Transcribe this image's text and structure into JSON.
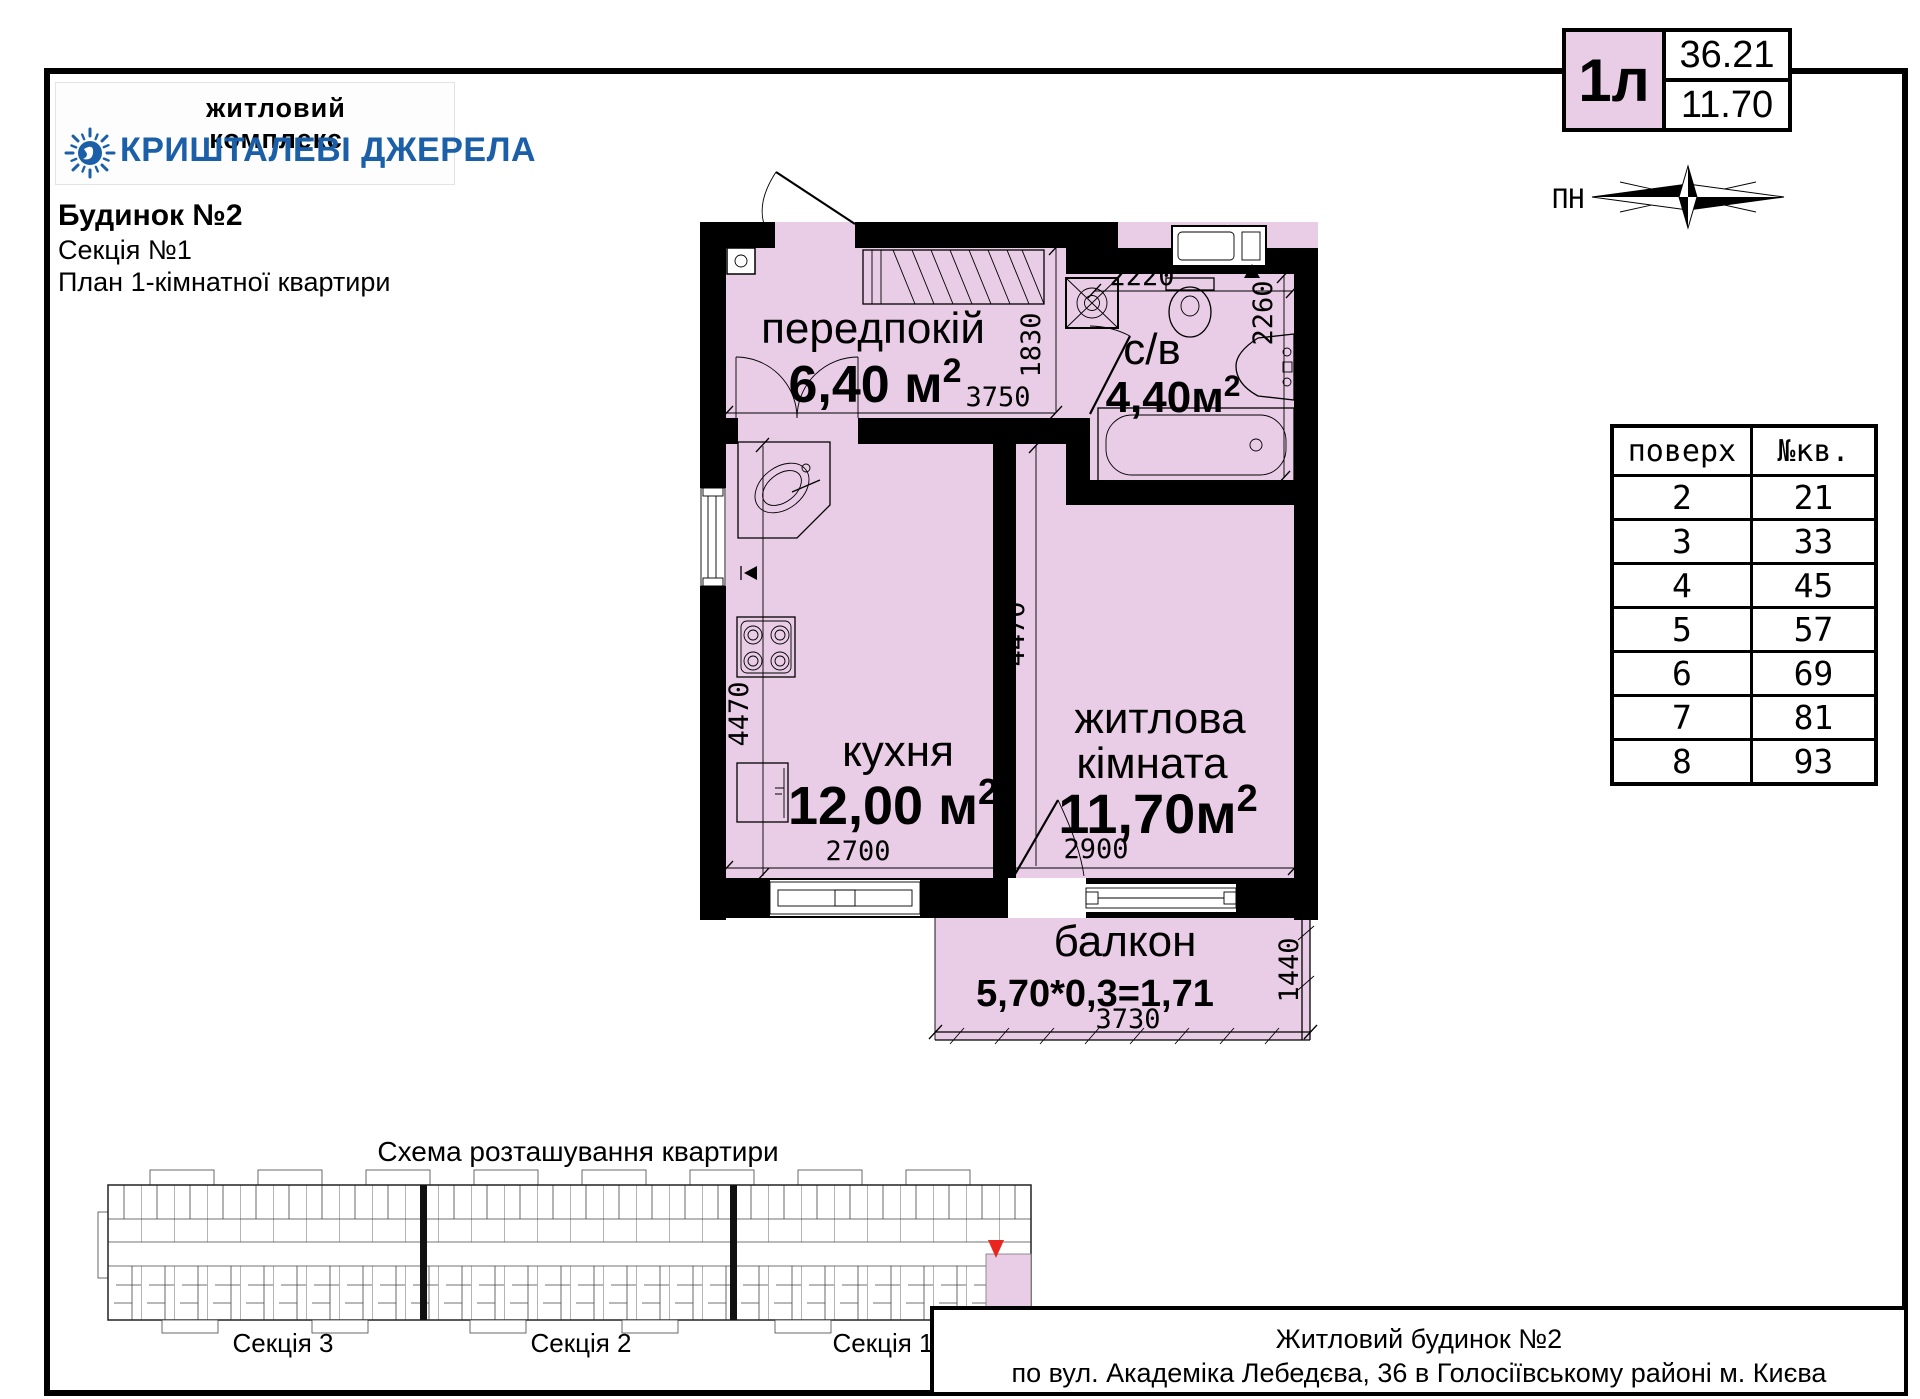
{
  "header": {
    "complex_label": "житловий комплекс",
    "complex_name": "КРИШТАЛЕВІ ДЖЕРЕЛА",
    "building": "Будинок №2",
    "section": "Секція №1",
    "plan_title": "План 1-кімнатної квартири"
  },
  "unit_badge": {
    "type": "1л",
    "area_total": "36.21",
    "area_living": "11.70"
  },
  "compass": {
    "north_label": "ПН"
  },
  "floors_table": {
    "col_floor": "поверх",
    "col_apt": "№кв.",
    "rows": [
      {
        "floor": "2",
        "apt": "21"
      },
      {
        "floor": "3",
        "apt": "33"
      },
      {
        "floor": "4",
        "apt": "45"
      },
      {
        "floor": "5",
        "apt": "57"
      },
      {
        "floor": "6",
        "apt": "69"
      },
      {
        "floor": "7",
        "apt": "81"
      },
      {
        "floor": "8",
        "apt": "93"
      }
    ]
  },
  "plan": {
    "sup2": "2",
    "rooms": {
      "hallway": {
        "name": "передпокій",
        "area": "6,40 м"
      },
      "bathroom": {
        "name": "с/в",
        "area": "4,40м"
      },
      "kitchen": {
        "name": "кухня",
        "area": "12,00 м"
      },
      "living": {
        "name_line1": "житлова",
        "name_line2": "кімната",
        "area": "11,70м"
      },
      "balcony": {
        "name": "балкон",
        "formula": "5,70*0,3=1,71"
      }
    },
    "dims": {
      "hallway_w": "3750",
      "hallway_h": "1830",
      "bathroom_w": "2220",
      "bathroom_h": "2260",
      "kitchen_w": "2700",
      "kitchen_h": "4470",
      "living_w": "2900",
      "living_h": "4470",
      "balcony_w": "3730",
      "balcony_h": "1440"
    }
  },
  "schema": {
    "title": "Схема розташування квартири",
    "sections": [
      "Секція 3",
      "Секція 2",
      "Секція 1"
    ]
  },
  "footer": {
    "line1": "Житловий будинок №2",
    "line2": "по вул. Академіка Лебедєва, 36 в Голосіївському районі м. Києва"
  },
  "colors": {
    "room_fill": "#e9cce5",
    "brand_blue": "#1b5fa8",
    "marker_red": "#e8251f",
    "wall": "#000000"
  }
}
